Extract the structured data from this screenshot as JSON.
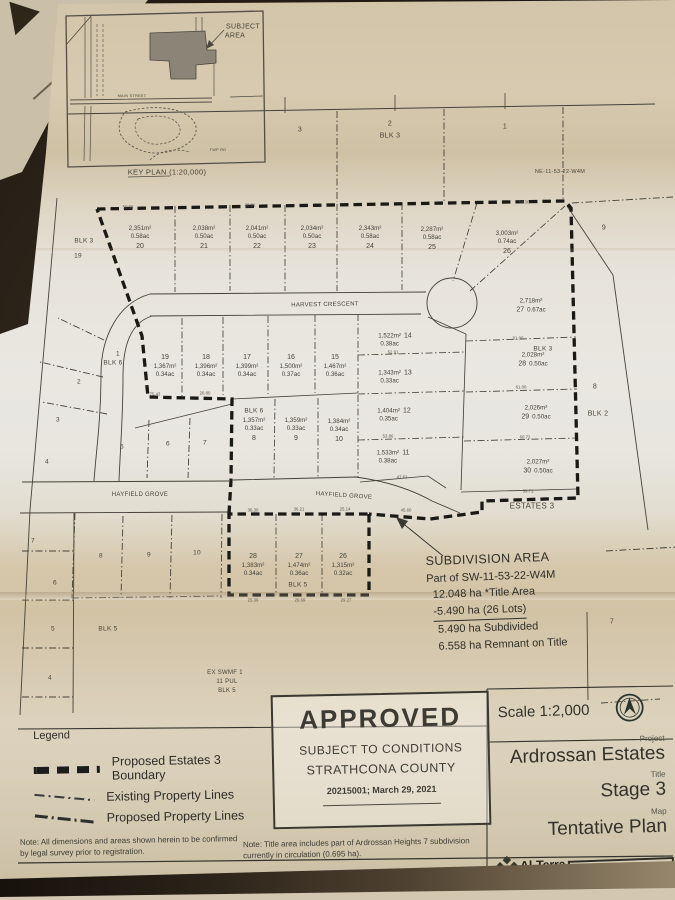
{
  "map": {
    "texts": [
      {
        "t": "SUBJECT",
        "x": 243,
        "y": 27,
        "s": 7
      },
      {
        "t": "AREA",
        "x": 235,
        "y": 36,
        "s": 7
      },
      {
        "t": "KEY PLAN (1:20,000)",
        "x": 167,
        "y": 172,
        "s": 7.5
      },
      {
        "t": "MAIN STREET",
        "x": 132,
        "y": 96,
        "s": 3.8
      },
      {
        "t": "TWP RD",
        "x": 218,
        "y": 150,
        "s": 3.8
      },
      {
        "t": "NE-11-53-22-W4M",
        "x": 560,
        "y": 172,
        "s": 5.5
      },
      {
        "t": "3",
        "x": 300,
        "y": 130,
        "s": 7
      },
      {
        "t": "2",
        "x": 390,
        "y": 124,
        "s": 7
      },
      {
        "t": "BLK 3",
        "x": 390,
        "y": 136,
        "s": 7
      },
      {
        "t": "1",
        "x": 505,
        "y": 127,
        "s": 7
      },
      {
        "t": "9",
        "x": 604,
        "y": 228,
        "s": 7
      },
      {
        "t": "BLK 3",
        "x": 84,
        "y": 241,
        "s": 6.5
      },
      {
        "t": "19",
        "x": 78,
        "y": 256,
        "s": 6.5
      },
      {
        "t": "HARVEST CRESCENT",
        "x": 325,
        "y": 305,
        "s": 6,
        "r": -1
      },
      {
        "t": "8",
        "x": 595,
        "y": 387,
        "s": 7
      },
      {
        "t": "BLK 2",
        "x": 598,
        "y": 414,
        "s": 7
      },
      {
        "t": "BLK 3",
        "x": 543,
        "y": 349,
        "s": 6.5
      },
      {
        "t": "BLK 6",
        "x": 254,
        "y": 411,
        "s": 6.5
      },
      {
        "t": "1",
        "x": 118,
        "y": 354,
        "s": 6.5
      },
      {
        "t": "BLK 6",
        "x": 113,
        "y": 363,
        "s": 6.5
      },
      {
        "t": "2",
        "x": 79,
        "y": 382,
        "s": 6.5
      },
      {
        "t": "3",
        "x": 58,
        "y": 420,
        "s": 6.5
      },
      {
        "t": "4",
        "x": 47,
        "y": 462,
        "s": 6.5
      },
      {
        "t": "5",
        "x": 122,
        "y": 447,
        "s": 6.5
      },
      {
        "t": "6",
        "x": 168,
        "y": 444,
        "s": 6.5
      },
      {
        "t": "7",
        "x": 205,
        "y": 443,
        "s": 6.5
      },
      {
        "t": "HAYFIELD GROVE",
        "x": 140,
        "y": 495,
        "s": 6
      },
      {
        "t": "HAYFIELD GROVE",
        "x": 344,
        "y": 496,
        "s": 6,
        "r": 4
      },
      {
        "t": "ESTATES 3",
        "x": 532,
        "y": 506,
        "s": 8
      },
      {
        "t": "7",
        "x": 33,
        "y": 541,
        "s": 6.5
      },
      {
        "t": "8",
        "x": 101,
        "y": 556,
        "s": 6.5
      },
      {
        "t": "9",
        "x": 149,
        "y": 555,
        "s": 6.5
      },
      {
        "t": "10",
        "x": 197,
        "y": 553,
        "s": 6.5
      },
      {
        "t": "6",
        "x": 55,
        "y": 583,
        "s": 6.5
      },
      {
        "t": "5",
        "x": 53,
        "y": 629,
        "s": 6.5
      },
      {
        "t": "BLK 5",
        "x": 108,
        "y": 629,
        "s": 6.5
      },
      {
        "t": "4",
        "x": 50,
        "y": 678,
        "s": 6.5
      },
      {
        "t": "EX SWMF 1",
        "x": 225,
        "y": 673,
        "s": 6
      },
      {
        "t": "11 PUL",
        "x": 227,
        "y": 682,
        "s": 6
      },
      {
        "t": "BLK 5",
        "x": 227,
        "y": 691,
        "s": 6
      },
      {
        "t": "BLK 5",
        "x": 298,
        "y": 585,
        "s": 6.5
      },
      {
        "t": "7",
        "x": 612,
        "y": 622,
        "s": 7
      }
    ],
    "dims": [
      {
        "t": "50.58",
        "x": 128,
        "y": 207
      },
      {
        "t": "38.01",
        "x": 250,
        "y": 205
      },
      {
        "t": "54.36",
        "x": 524,
        "y": 202
      },
      {
        "t": "75.43",
        "x": 155,
        "y": 394
      },
      {
        "t": "26.80",
        "x": 205,
        "y": 393
      },
      {
        "t": "52.91",
        "x": 393,
        "y": 352
      },
      {
        "t": "53.86",
        "x": 388,
        "y": 436
      },
      {
        "t": "47.62",
        "x": 402,
        "y": 477
      },
      {
        "t": "45.60",
        "x": 406,
        "y": 510
      },
      {
        "t": "36.30",
        "x": 253,
        "y": 510
      },
      {
        "t": "36.21",
        "x": 299,
        "y": 509
      },
      {
        "t": "25.14",
        "x": 345,
        "y": 509
      },
      {
        "t": "25.39",
        "x": 253,
        "y": 600
      },
      {
        "t": "29.69",
        "x": 300,
        "y": 600
      },
      {
        "t": "29.27",
        "x": 346,
        "y": 600
      },
      {
        "t": "61.00",
        "x": 518,
        "y": 338
      },
      {
        "t": "61.00",
        "x": 521,
        "y": 387
      },
      {
        "t": "60.72",
        "x": 525,
        "y": 437
      },
      {
        "t": "59.71",
        "x": 528,
        "y": 491
      }
    ],
    "lots": [
      {
        "no": "20",
        "area": "2,351m²",
        "ac": "0.58ac",
        "x": 140,
        "y": 238,
        "v": "below"
      },
      {
        "no": "21",
        "area": "2,038m²",
        "ac": "0.50ac",
        "x": 204,
        "y": 238,
        "v": "below"
      },
      {
        "no": "22",
        "area": "2,041m²",
        "ac": "0.50ac",
        "x": 257,
        "y": 238,
        "v": "below"
      },
      {
        "no": "23",
        "area": "2,034m²",
        "ac": "0.50ac",
        "x": 312,
        "y": 238,
        "v": "below"
      },
      {
        "no": "24",
        "area": "2,343m²",
        "ac": "0.58ac",
        "x": 370,
        "y": 238,
        "v": "below"
      },
      {
        "no": "25",
        "area": "2,287m²",
        "ac": "0.58ac",
        "x": 432,
        "y": 239,
        "v": "below"
      },
      {
        "no": "26",
        "area": "3,003m²",
        "ac": "0.74ac",
        "x": 507,
        "y": 243,
        "v": "below"
      },
      {
        "no": "27",
        "area": "2,718m²",
        "ac": "0.67ac",
        "x": 531,
        "y": 306,
        "v": "left"
      },
      {
        "no": "28",
        "area": "2,028m²",
        "ac": "0.50ac",
        "x": 533,
        "y": 360,
        "v": "left"
      },
      {
        "no": "29",
        "area": "2,026m²",
        "ac": "0.50ac",
        "x": 536,
        "y": 413,
        "v": "left"
      },
      {
        "no": "30",
        "area": "2,027m²",
        "ac": "0.50ac",
        "x": 538,
        "y": 467,
        "v": "left"
      },
      {
        "no": "19",
        "area": "1,367m²",
        "ac": "0.34ac",
        "x": 165,
        "y": 366,
        "v": "above"
      },
      {
        "no": "18",
        "area": "1,396m²",
        "ac": "0.34ac",
        "x": 206,
        "y": 366,
        "v": "above"
      },
      {
        "no": "17",
        "area": "1,399m²",
        "ac": "0.34ac",
        "x": 247,
        "y": 366,
        "v": "above"
      },
      {
        "no": "16",
        "area": "1,500m²",
        "ac": "0.37ac",
        "x": 291,
        "y": 366,
        "v": "above"
      },
      {
        "no": "15",
        "area": "1,467m²",
        "ac": "0.36ac",
        "x": 335,
        "y": 366,
        "v": "above"
      },
      {
        "no": "14",
        "area": "1,522m²",
        "ac": "0.38ac",
        "x": 395,
        "y": 340,
        "v": "right"
      },
      {
        "no": "13",
        "area": "1,343m²",
        "ac": "0.33ac",
        "x": 395,
        "y": 377,
        "v": "right"
      },
      {
        "no": "12",
        "area": "1,404m²",
        "ac": "0.35ac",
        "x": 394,
        "y": 415,
        "v": "right"
      },
      {
        "no": "11",
        "area": "1,533m²",
        "ac": "0.38ac",
        "x": 393,
        "y": 457,
        "v": "right"
      },
      {
        "no": "8",
        "area": "1,357m²",
        "ac": "0.33ac",
        "x": 254,
        "y": 430,
        "v": "below"
      },
      {
        "no": "9",
        "area": "1,359m²",
        "ac": "0.33ac",
        "x": 296,
        "y": 430,
        "v": "below"
      },
      {
        "no": "10",
        "area": "1,384m²",
        "ac": "0.34ac",
        "x": 339,
        "y": 431,
        "v": "below"
      },
      {
        "no": "28",
        "area": "1,383m²",
        "ac": "0.34ac",
        "x": 253,
        "y": 565,
        "v": "above"
      },
      {
        "no": "27",
        "area": "1,474m²",
        "ac": "0.36ac",
        "x": 299,
        "y": 565,
        "v": "above"
      },
      {
        "no": "26",
        "area": "1,315m²",
        "ac": "0.32ac",
        "x": 343,
        "y": 565,
        "v": "above"
      }
    ],
    "subdivision_note": {
      "title": "SUBDIVISION AREA",
      "line1": "Part of SW-11-53-22-W4M",
      "line2": "12.048 ha *Title Area",
      "line3": "-5.490 ha (26 Lots)",
      "line4": "5.490 ha Subdivided",
      "line5": "6.558 ha Remnant on Title"
    }
  },
  "legend": {
    "title": "Legend",
    "items": [
      {
        "label": "Proposed Estates 3 Boundary",
        "sym": "boundary"
      },
      {
        "label": "Existing Property Lines",
        "sym": "existing"
      },
      {
        "label": "Proposed Property Lines",
        "sym": "proposed"
      }
    ]
  },
  "stamp": {
    "line1": "APPROVED",
    "line2": "SUBJECT TO CONDITIONS",
    "line3": "STRATHCONA COUNTY",
    "line4": "20215001; March 29, 2021"
  },
  "title_block": {
    "scale": "Scale 1:2,000",
    "north_letter": "N",
    "project_label": "Project",
    "project": "Ardrossan Estates",
    "title_label": "Title",
    "title": "Stage 3",
    "map_label": "Map",
    "map": "Tentative Plan",
    "firm": "Al-Terra",
    "firm_sub": "Engineering Ltd.",
    "date": "January 11, 2021"
  },
  "notes": {
    "note1": "Note: All dimensions and areas shown herein to be confirmed by legal survey prior to registration.",
    "note2": "Note: Title area includes part of Ardrossan Heights 7 subdivision currently in circulation (0.695 ha)."
  }
}
